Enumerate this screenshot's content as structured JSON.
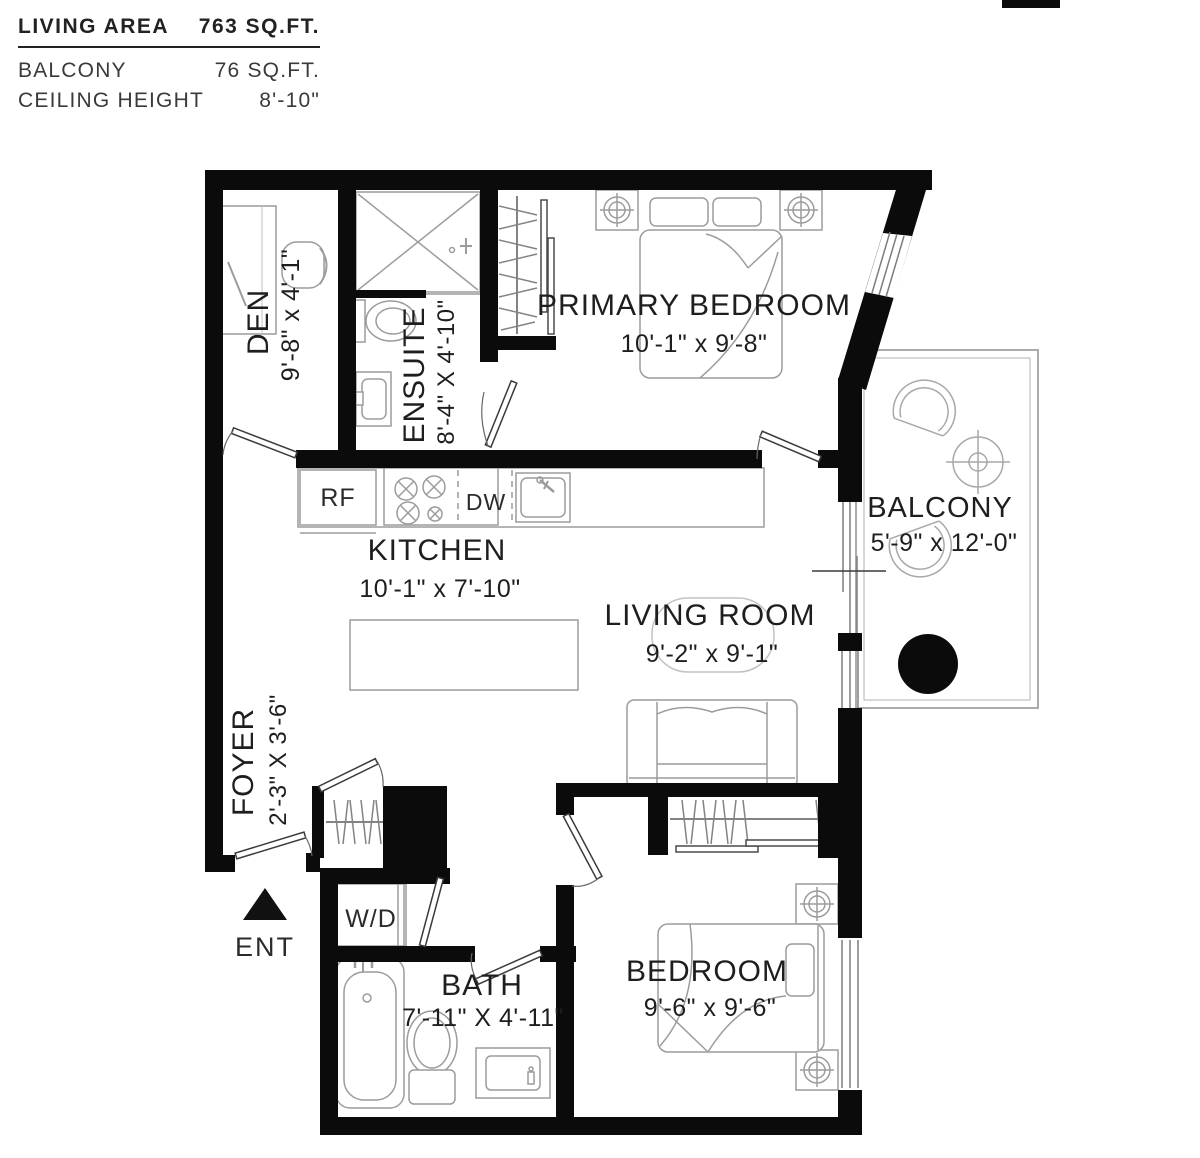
{
  "legend": {
    "rows": [
      {
        "label": "LIVING AREA",
        "value": "763 SQ.FT."
      },
      {
        "label": "BALCONY",
        "value": "76 SQ.FT."
      },
      {
        "label": "CEILING HEIGHT",
        "value": "8'-10\""
      }
    ]
  },
  "rooms": {
    "primary_bedroom": {
      "name": "PRIMARY BEDROOM",
      "dims": "10'-1\"  x  9'-8\""
    },
    "kitchen": {
      "name": "KITCHEN",
      "dims": "10'-1\"  x  7'-10\""
    },
    "living_room": {
      "name": "LIVING ROOM",
      "dims": "9'-2\"  x  9'-1\""
    },
    "balcony": {
      "name": "BALCONY",
      "dims": "5'-9\" x 12'-0\""
    },
    "bedroom": {
      "name": "BEDROOM",
      "dims": "9'-6\"  x  9'-6\""
    },
    "bath": {
      "name": "BATH",
      "dims": "7'-11\" X 4'-11\""
    },
    "den": {
      "name": "DEN",
      "dims": "9'-8\"  x  4'-1\""
    },
    "ensuite": {
      "name": "ENSUITE",
      "dims": "8'-4\" X 4'-10\""
    },
    "foyer": {
      "name": "FOYER",
      "dims": "2'-3\" X 3'-6\""
    }
  },
  "labels": {
    "fridge": "RF",
    "dishwasher": "DW",
    "washer_dryer": "W/D",
    "entrance": "ENT"
  },
  "colors": {
    "wall": "#0b0b0b",
    "furniture_line": "#9c9c9c",
    "door_line": "#3a3a3a",
    "text": "#1e1e1e"
  }
}
